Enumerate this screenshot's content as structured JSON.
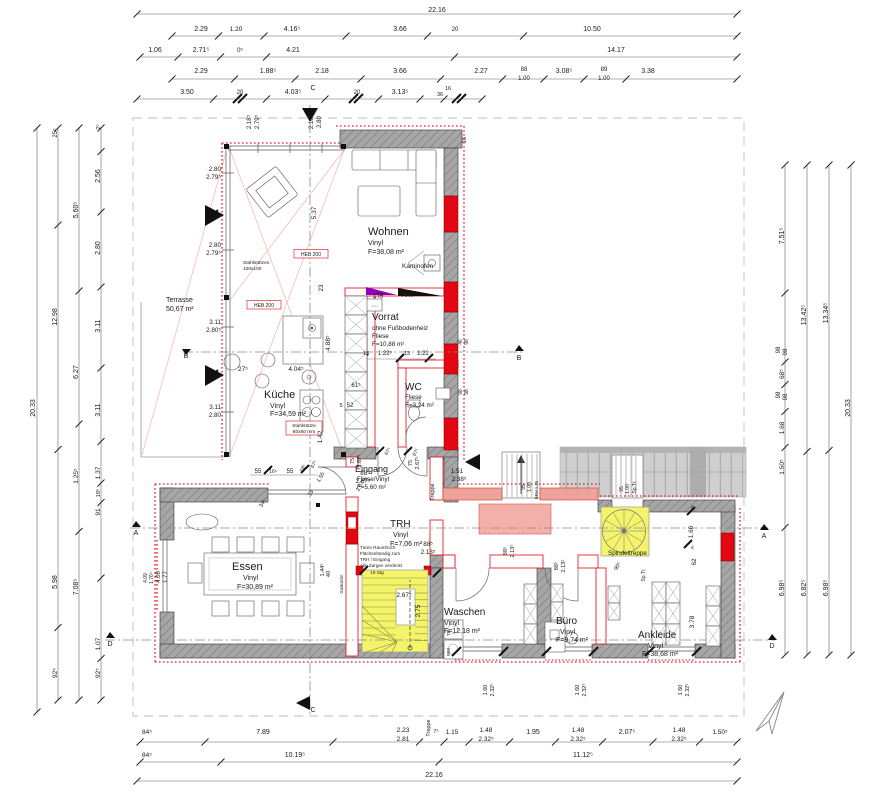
{
  "colors": {
    "wall_gray": "#9a9a9a",
    "accent_red": "#e30613",
    "stair_yellow": "#f4f46a",
    "salmon_wall": "#f0a39b",
    "purple_wedge": "#8c00c4",
    "exterior_gray": "#cfcfcf"
  },
  "rooms": {
    "wohnen": {
      "name": "Wohnen",
      "floor": "Vinyl",
      "area": "F=38,08 m²"
    },
    "vorrat": {
      "name": "Vorrat",
      "note": "ohne Fußbodenheiz",
      "floor": "Fliese",
      "area": "F=10,88 m²"
    },
    "wc": {
      "name": "WC",
      "floor": "Fliese",
      "area": "F=3,24 m²"
    },
    "kueche": {
      "name": "Küche",
      "floor": "Vinyl",
      "area": "F=34,59 m²"
    },
    "eingang": {
      "name": "Eingang",
      "floor": "Fliese/Vinyl",
      "area": "F=5,60 m²"
    },
    "trh": {
      "name": "TRH",
      "floor": "Vinyl",
      "area": "F=7,06 m²"
    },
    "essen": {
      "name": "Essen",
      "floor": "Vinyl",
      "area": "F=30,89 m²"
    },
    "waschen": {
      "name": "Waschen",
      "floor": "Vinyl",
      "area": "F=12,18 m²"
    },
    "buero": {
      "name": "Büro",
      "floor": "Vinyl",
      "area": "F=9,74 m²"
    },
    "ankleide": {
      "name": "Ankleide",
      "floor": "Vinyl",
      "area": "F=38,68 m²"
    },
    "terrasse": {
      "name": "Terrasse",
      "area": "50,67 m²"
    }
  },
  "annotations": [
    {
      "t": "22.16",
      "x": 437,
      "y": 12
    },
    {
      "t": "2.29",
      "x": 201,
      "y": 31
    },
    {
      "t": "1.20",
      "x": 236,
      "y": 31,
      "s": 6.5
    },
    {
      "t": "4.16⁵",
      "x": 292,
      "y": 31
    },
    {
      "t": "3.66",
      "x": 400,
      "y": 31
    },
    {
      "t": "20",
      "x": 455,
      "y": 31,
      "s": 6
    },
    {
      "t": "10.50",
      "x": 592,
      "y": 31
    },
    {
      "t": "1.06",
      "x": 155,
      "y": 52
    },
    {
      "t": "2.71⁵",
      "x": 201,
      "y": 52
    },
    {
      "t": "0⁵",
      "x": 240,
      "y": 52,
      "s": 6
    },
    {
      "t": "4.21",
      "x": 293,
      "y": 52
    },
    {
      "t": "14.17",
      "x": 616,
      "y": 52
    },
    {
      "t": "2.29",
      "x": 201,
      "y": 73
    },
    {
      "t": "1.88⁵",
      "x": 268,
      "y": 73
    },
    {
      "t": "2.18",
      "x": 322,
      "y": 73
    },
    {
      "t": "3.66",
      "x": 400,
      "y": 73
    },
    {
      "t": "2.27",
      "x": 481,
      "y": 73
    },
    {
      "t": "88",
      "x": 524,
      "y": 71,
      "s": 6
    },
    {
      "t": "1.00",
      "x": 524,
      "y": 80,
      "s": 6
    },
    {
      "t": "3.08⁵",
      "x": 564,
      "y": 73
    },
    {
      "t": "89",
      "x": 604,
      "y": 71,
      "s": 6
    },
    {
      "t": "1.00",
      "x": 604,
      "y": 80,
      "s": 6
    },
    {
      "t": "3.38",
      "x": 648,
      "y": 73
    },
    {
      "t": "3.50",
      "x": 187,
      "y": 94
    },
    {
      "t": "20",
      "x": 240,
      "y": 94,
      "s": 6
    },
    {
      "t": "4.03⁵",
      "x": 293,
      "y": 94
    },
    {
      "t": "20",
      "x": 357,
      "y": 94,
      "s": 6
    },
    {
      "t": "3.13⁵",
      "x": 400,
      "y": 94
    },
    {
      "t": "16",
      "x": 448,
      "y": 90,
      "s": 5.5
    },
    {
      "t": "36",
      "x": 440,
      "y": 96,
      "s": 5.5
    },
    {
      "t": "C",
      "x": 313,
      "y": 90,
      "s": 7,
      "n": "section-marker-c"
    },
    {
      "t": "2.18⁵",
      "x": 251,
      "y": 122,
      "r": -90,
      "s": 6
    },
    {
      "t": "2.79⁵",
      "x": 259,
      "y": 122,
      "r": -90,
      "s": 6
    },
    {
      "t": "2.18⁵",
      "x": 313,
      "y": 122,
      "r": -90,
      "s": 6
    },
    {
      "t": "2.80",
      "x": 321,
      "y": 122,
      "r": -90,
      "s": 6
    },
    {
      "t": "16",
      "x": 466,
      "y": 140,
      "r": -90,
      "s": 5.5
    },
    {
      "t": "20.33",
      "x": 35,
      "y": 408,
      "r": -90
    },
    {
      "t": "12.98",
      "x": 57,
      "y": 317,
      "r": -90
    },
    {
      "t": "25⁵",
      "x": 57,
      "y": 133,
      "r": -90,
      "s": 6
    },
    {
      "t": "5.98",
      "x": 57,
      "y": 582,
      "r": -90
    },
    {
      "t": "92⁵",
      "x": 57,
      "y": 673,
      "r": -90,
      "s": 6.5
    },
    {
      "t": "5.60⁵",
      "x": 78,
      "y": 210,
      "r": -90
    },
    {
      "t": "6.27",
      "x": 78,
      "y": 372,
      "r": -90
    },
    {
      "t": "1.25⁵",
      "x": 78,
      "y": 476,
      "r": -90,
      "s": 6.5
    },
    {
      "t": "7.08⁵",
      "x": 78,
      "y": 587,
      "r": -90
    },
    {
      "t": "2⁵",
      "x": 100,
      "y": 127,
      "r": -90,
      "s": 5.5
    },
    {
      "t": "2.56",
      "x": 100,
      "y": 176,
      "r": -90
    },
    {
      "t": "2.80",
      "x": 100,
      "y": 248,
      "r": -90
    },
    {
      "t": "3.11",
      "x": 100,
      "y": 326,
      "r": -90
    },
    {
      "t": "3.11",
      "x": 100,
      "y": 410,
      "r": -90
    },
    {
      "t": "1.37",
      "x": 100,
      "y": 473,
      "r": -90,
      "s": 6.5
    },
    {
      "t": "18⁵",
      "x": 100,
      "y": 493,
      "r": -90,
      "s": 5.5
    },
    {
      "t": "91",
      "x": 100,
      "y": 512,
      "r": -90,
      "s": 6.5
    },
    {
      "t": "1.07",
      "x": 100,
      "y": 644,
      "r": -90,
      "s": 6.5
    },
    {
      "t": "92⁵",
      "x": 100,
      "y": 673,
      "r": -90,
      "s": 6.5
    },
    {
      "t": "2.80",
      "x": 221,
      "y": 171,
      "s": 6.3,
      "a": "end"
    },
    {
      "t": "2.79⁵",
      "x": 221,
      "y": 179,
      "s": 6.3,
      "a": "end"
    },
    {
      "t": "2.80",
      "x": 221,
      "y": 247,
      "s": 6.3,
      "a": "end"
    },
    {
      "t": "2.79⁵",
      "x": 221,
      "y": 255,
      "s": 6.3,
      "a": "end"
    },
    {
      "t": "3.11",
      "x": 221,
      "y": 324,
      "s": 6.3,
      "a": "end"
    },
    {
      "t": "2.80⁵",
      "x": 221,
      "y": 332,
      "s": 6.3,
      "a": "end"
    },
    {
      "t": "3.11",
      "x": 221,
      "y": 409,
      "s": 6.3,
      "a": "end"
    },
    {
      "t": "2.80",
      "x": 221,
      "y": 417,
      "s": 6.3,
      "a": "end"
    },
    {
      "t": "B",
      "x": 186,
      "y": 358,
      "s": 7,
      "n": "section-marker-b"
    },
    {
      "t": "A",
      "x": 136,
      "y": 535,
      "s": 7,
      "n": "section-marker-a"
    },
    {
      "t": "D",
      "x": 110,
      "y": 646,
      "s": 7,
      "n": "section-marker-d"
    },
    {
      "t": "4.00",
      "x": 160,
      "y": 577,
      "r": -90,
      "s": 6
    },
    {
      "t": "1.77",
      "x": 167,
      "y": 577,
      "r": -90,
      "s": 6
    },
    {
      "t": "4.09",
      "x": 147,
      "y": 578,
      "r": -90,
      "s": 5
    },
    {
      "t": "1.76⁵",
      "x": 153,
      "y": 578,
      "r": -90,
      "s": 5
    },
    {
      "t": "7.51⁵",
      "x": 784,
      "y": 236,
      "r": -90
    },
    {
      "t": "98",
      "x": 780,
      "y": 350,
      "r": -90,
      "s": 6
    },
    {
      "t": "98",
      "x": 787,
      "y": 352,
      "r": -90,
      "s": 6
    },
    {
      "t": "68⁵",
      "x": 784,
      "y": 374,
      "r": -90,
      "s": 6.5
    },
    {
      "t": "98",
      "x": 780,
      "y": 395,
      "r": -90,
      "s": 6
    },
    {
      "t": "98",
      "x": 787,
      "y": 397,
      "r": -90,
      "s": 6
    },
    {
      "t": "1.68",
      "x": 784,
      "y": 428,
      "r": -90,
      "s": 6.5
    },
    {
      "t": "1.50⁵",
      "x": 784,
      "y": 467,
      "r": -90,
      "s": 6.5
    },
    {
      "t": "6.98⁵",
      "x": 784,
      "y": 588,
      "r": -90
    },
    {
      "t": "13.42⁵",
      "x": 806,
      "y": 315,
      "r": -90
    },
    {
      "t": "6.82⁵",
      "x": 806,
      "y": 588,
      "r": -90
    },
    {
      "t": "13.34⁵",
      "x": 828,
      "y": 313,
      "r": -90
    },
    {
      "t": "6.98⁵",
      "x": 828,
      "y": 588,
      "r": -90
    },
    {
      "t": "20.33",
      "x": 850,
      "y": 408,
      "r": -90
    },
    {
      "t": "A",
      "x": 764,
      "y": 538,
      "s": 7,
      "n": "section-marker-a"
    },
    {
      "t": "D",
      "x": 772,
      "y": 648,
      "s": 7,
      "n": "section-marker-d"
    },
    {
      "t": "B",
      "x": 519,
      "y": 360,
      "s": 7,
      "n": "section-marker-b"
    },
    {
      "t": "C",
      "x": 313,
      "y": 712,
      "s": 7,
      "n": "section-marker-c"
    },
    {
      "t": "84⁵",
      "x": 147,
      "y": 734,
      "s": 6.5
    },
    {
      "t": "7.89",
      "x": 263,
      "y": 734
    },
    {
      "t": "2.23",
      "x": 403,
      "y": 732,
      "s": 6.5
    },
    {
      "t": "2.81",
      "x": 403,
      "y": 741,
      "s": 6.5
    },
    {
      "t": "7⁵",
      "x": 436,
      "y": 733,
      "s": 5.5
    },
    {
      "t": "1.15",
      "x": 452,
      "y": 734,
      "s": 6.5
    },
    {
      "t": "1.48",
      "x": 486,
      "y": 732,
      "s": 6.5
    },
    {
      "t": "2.32⁵",
      "x": 486,
      "y": 741,
      "s": 6.5
    },
    {
      "t": "1.95",
      "x": 533,
      "y": 734
    },
    {
      "t": "1.48",
      "x": 578,
      "y": 732,
      "s": 6.5
    },
    {
      "t": "2.32⁵",
      "x": 578,
      "y": 741,
      "s": 6.5
    },
    {
      "t": "2.07⁵",
      "x": 627,
      "y": 734
    },
    {
      "t": "1.48",
      "x": 679,
      "y": 732,
      "s": 6.5
    },
    {
      "t": "2.32⁵",
      "x": 679,
      "y": 741,
      "s": 6.5
    },
    {
      "t": "1.50⁵",
      "x": 720,
      "y": 734,
      "s": 6.5
    },
    {
      "t": "84⁵",
      "x": 147,
      "y": 757,
      "s": 6.5
    },
    {
      "t": "10.19⁵",
      "x": 295,
      "y": 757
    },
    {
      "t": "11.12⁵",
      "x": 583,
      "y": 757
    },
    {
      "t": "22.16",
      "x": 434,
      "y": 777
    },
    {
      "t": "Treppe",
      "x": 430,
      "y": 728,
      "r": -90,
      "s": 5.5
    },
    {
      "t": "5.37",
      "x": 316,
      "y": 213,
      "r": -90,
      "s": 6.5
    },
    {
      "t": "23",
      "x": 323,
      "y": 288,
      "r": -90,
      "s": 6
    },
    {
      "t": "Kaminofen",
      "x": 402,
      "y": 268,
      "s": 6.5,
      "a": "start",
      "n": "kaminofen-label"
    },
    {
      "t": "ELT",
      "x": 378,
      "y": 293,
      "r": 180,
      "s": 6,
      "n": "elt-label"
    },
    {
      "t": "HKV",
      "x": 408,
      "y": 297,
      "s": 6,
      "n": "hkv-label"
    },
    {
      "t": "···",
      "x": 375,
      "y": 308,
      "s": 7
    },
    {
      "t": "HEB 200",
      "x": 311,
      "y": 256,
      "s": 5,
      "c": "#e30613",
      "n": "steel-beam-note"
    },
    {
      "t": "HEB 200",
      "x": 264,
      "y": 307,
      "s": 5,
      "c": "#e30613",
      "n": "steel-beam-note"
    },
    {
      "t": "Stahlstützen",
      "x": 243,
      "y": 264,
      "s": 4.8,
      "c": "#e30613",
      "a": "start",
      "n": "steel-column-note"
    },
    {
      "t": "100x100",
      "x": 243,
      "y": 270,
      "s": 4.8,
      "c": "#e30613",
      "a": "start",
      "n": "steel-column-note"
    },
    {
      "t": "Stahlstütze",
      "x": 304,
      "y": 427,
      "s": 4.8,
      "c": "#e30613",
      "n": "steel-column-note"
    },
    {
      "t": "80x80 mm",
      "x": 304,
      "y": 433,
      "s": 4.8,
      "c": "#e30613",
      "n": "steel-column-note"
    },
    {
      "t": "4.04⁵",
      "x": 296,
      "y": 371,
      "s": 6.5
    },
    {
      "t": "4.88⁵",
      "x": 330,
      "y": 343,
      "r": -90,
      "s": 6.5
    },
    {
      "t": "27⁵",
      "x": 243,
      "y": 371,
      "s": 6.5
    },
    {
      "t": "13",
      "x": 366,
      "y": 355,
      "s": 5.5
    },
    {
      "t": "1.22⁵",
      "x": 385,
      "y": 355,
      "s": 6
    },
    {
      "t": "13",
      "x": 407,
      "y": 355,
      "s": 5.5
    },
    {
      "t": "1.22",
      "x": 423,
      "y": 355,
      "s": 6
    },
    {
      "t": "61⁵",
      "x": 356,
      "y": 387,
      "s": 6
    },
    {
      "t": "5",
      "x": 341,
      "y": 407,
      "s": 5.5
    },
    {
      "t": "52",
      "x": 350,
      "y": 407,
      "s": 6
    },
    {
      "t": "1.42",
      "x": 322,
      "y": 437,
      "r": -90,
      "s": 6.5
    },
    {
      "t": "46",
      "x": 462,
      "y": 342,
      "r": -90,
      "s": 5
    },
    {
      "t": "98",
      "x": 468,
      "y": 342,
      "r": -90,
      "s": 5
    },
    {
      "t": "98",
      "x": 462,
      "y": 392,
      "r": -90,
      "s": 5
    },
    {
      "t": "98",
      "x": 468,
      "y": 392,
      "r": -90,
      "s": 5
    },
    {
      "t": "55",
      "x": 258,
      "y": 473,
      "s": 6
    },
    {
      "t": "16⁵",
      "x": 273,
      "y": 473,
      "s": 5
    },
    {
      "t": "55",
      "x": 290,
      "y": 473,
      "s": 6
    },
    {
      "t": "18⁵",
      "x": 304,
      "y": 469,
      "r": -60,
      "s": 5
    },
    {
      "t": "67⁵",
      "x": 315,
      "y": 465,
      "r": -60,
      "s": 5
    },
    {
      "t": "34⁵",
      "x": 264,
      "y": 504,
      "r": -60,
      "s": 5.5
    },
    {
      "t": "33",
      "x": 312,
      "y": 494,
      "r": -60,
      "s": 5.5
    },
    {
      "t": "1.55",
      "x": 322,
      "y": 478,
      "r": -60,
      "s": 5.5
    },
    {
      "t": "2.67⁵",
      "x": 362,
      "y": 486,
      "r": -60,
      "s": 5.5
    },
    {
      "t": "75",
      "x": 354,
      "y": 461,
      "r": -90,
      "s": 5.5
    },
    {
      "t": "2.67⁵",
      "x": 361,
      "y": 461,
      "r": -90,
      "s": 5.5
    },
    {
      "t": "75",
      "x": 412,
      "y": 463,
      "r": -90,
      "s": 5.5
    },
    {
      "t": "2.67⁵",
      "x": 419,
      "y": 463,
      "r": -90,
      "s": 5.5
    },
    {
      "t": "88⁵",
      "x": 365,
      "y": 475,
      "s": 6.3
    },
    {
      "t": "2.67⁵",
      "x": 363,
      "y": 483,
      "s": 6.3
    },
    {
      "t": "1.51",
      "x": 457,
      "y": 473,
      "s": 6.3
    },
    {
      "t": "2.38⁵",
      "x": 459,
      "y": 481,
      "s": 6.3
    },
    {
      "t": "Treppe",
      "x": 434,
      "y": 492,
      "r": -90,
      "s": 5.5,
      "n": "treppe-label"
    },
    {
      "t": "67⁵",
      "x": 389,
      "y": 452,
      "r": -60,
      "s": 5
    },
    {
      "t": "67⁵",
      "x": 417,
      "y": 453,
      "r": -60,
      "s": 5
    },
    {
      "t": "95",
      "x": 525,
      "y": 487,
      "r": -90,
      "s": 5
    },
    {
      "t": "1.00",
      "x": 531,
      "y": 487,
      "r": -90,
      "s": 5
    },
    {
      "t": "BRH 1.15",
      "x": 538,
      "y": 490,
      "r": -90,
      "s": 4.2
    },
    {
      "t": "95",
      "x": 623,
      "y": 489,
      "r": -90,
      "s": 5
    },
    {
      "t": "1.00",
      "x": 629,
      "y": 489,
      "r": -90,
      "s": 5
    },
    {
      "t": "Sp.Tr.",
      "x": 636,
      "y": 487,
      "r": -90,
      "s": 5
    },
    {
      "t": "88⁵",
      "x": 428,
      "y": 546,
      "s": 6.3
    },
    {
      "t": "2.13⁵",
      "x": 428,
      "y": 554,
      "s": 6.3
    },
    {
      "t": "88⁵",
      "x": 507,
      "y": 551,
      "r": -90,
      "s": 5.5
    },
    {
      "t": "2.13⁵",
      "x": 514,
      "y": 551,
      "r": -90,
      "s": 5.5
    },
    {
      "t": "88⁵",
      "x": 558,
      "y": 566,
      "r": -90,
      "s": 5.5
    },
    {
      "t": "2.13⁵",
      "x": 565,
      "y": 566,
      "r": -90,
      "s": 5.5
    },
    {
      "t": "90⁵",
      "x": 619,
      "y": 567,
      "r": -60,
      "s": 5.5
    },
    {
      "t": "Sp.Tr.",
      "x": 645,
      "y": 575,
      "r": -90,
      "s": 5
    },
    {
      "t": "Spindeltreppe",
      "x": 608,
      "y": 555,
      "s": 6.3,
      "a": "start",
      "n": "spindeltreppe-label"
    },
    {
      "t": "1.60",
      "x": 693,
      "y": 532,
      "r": -90,
      "s": 6.3
    },
    {
      "t": "4⁵",
      "x": 694,
      "y": 508,
      "r": -60,
      "s": 4.5
    },
    {
      "t": "62",
      "x": 696,
      "y": 562,
      "r": -90,
      "s": 6.3
    },
    {
      "t": "4⁵",
      "x": 694,
      "y": 548,
      "r": -60,
      "s": 4.5
    },
    {
      "t": "3.78",
      "x": 694,
      "y": 622,
      "r": -90,
      "s": 6.5
    },
    {
      "t": "2.67⁵",
      "x": 404,
      "y": 597,
      "s": 6.5
    },
    {
      "t": "2.75",
      "x": 420,
      "y": 611,
      "r": -90,
      "s": 6.5
    },
    {
      "t": "Türen Raumhoch",
      "x": 360,
      "y": 549,
      "s": 4.6,
      "c": "#e30613",
      "a": "start",
      "n": "door-note"
    },
    {
      "t": "Flächenbündig zum",
      "x": 360,
      "y": 555,
      "s": 4.6,
      "c": "#e30613",
      "a": "start",
      "n": "door-note"
    },
    {
      "t": "TRH / Eingang",
      "x": 360,
      "y": 561,
      "s": 4.6,
      "c": "#e30613",
      "a": "start",
      "n": "door-note"
    },
    {
      "t": "Alle Zargen verdeckt",
      "x": 360,
      "y": 567,
      "s": 4.6,
      "c": "#e30613",
      "a": "start",
      "n": "door-note"
    },
    {
      "t": "19 Stg",
      "x": 377,
      "y": 574,
      "s": 4.6,
      "n": "stair-count-label"
    },
    {
      "t": "1.44⁵",
      "x": 324,
      "y": 570,
      "r": -90,
      "s": 5.5
    },
    {
      "t": "40",
      "x": 330,
      "y": 574,
      "r": -90,
      "s": 5.5
    },
    {
      "t": "Gaskamin",
      "x": 343,
      "y": 584,
      "r": -90,
      "s": 4.2,
      "c": "#e30613"
    },
    {
      "t": "TR",
      "x": 450,
      "y": 633,
      "r": -90,
      "s": 4.5,
      "n": "dryer-label"
    },
    {
      "t": "WM",
      "x": 450,
      "y": 652,
      "r": -90,
      "s": 4.5,
      "n": "washer-label"
    },
    {
      "t": "1.60",
      "x": 487,
      "y": 690,
      "r": -90,
      "s": 5.5
    },
    {
      "t": "2.32⁵",
      "x": 494,
      "y": 690,
      "r": -90,
      "s": 5.5
    },
    {
      "t": "1.60",
      "x": 579,
      "y": 690,
      "r": -90,
      "s": 5.5
    },
    {
      "t": "2.32⁵",
      "x": 586,
      "y": 690,
      "r": -90,
      "s": 5.5
    },
    {
      "t": "1.60",
      "x": 682,
      "y": 690,
      "r": -90,
      "s": 5.5
    },
    {
      "t": "2.32⁵",
      "x": 689,
      "y": 690,
      "r": -90,
      "s": 5.5
    }
  ]
}
